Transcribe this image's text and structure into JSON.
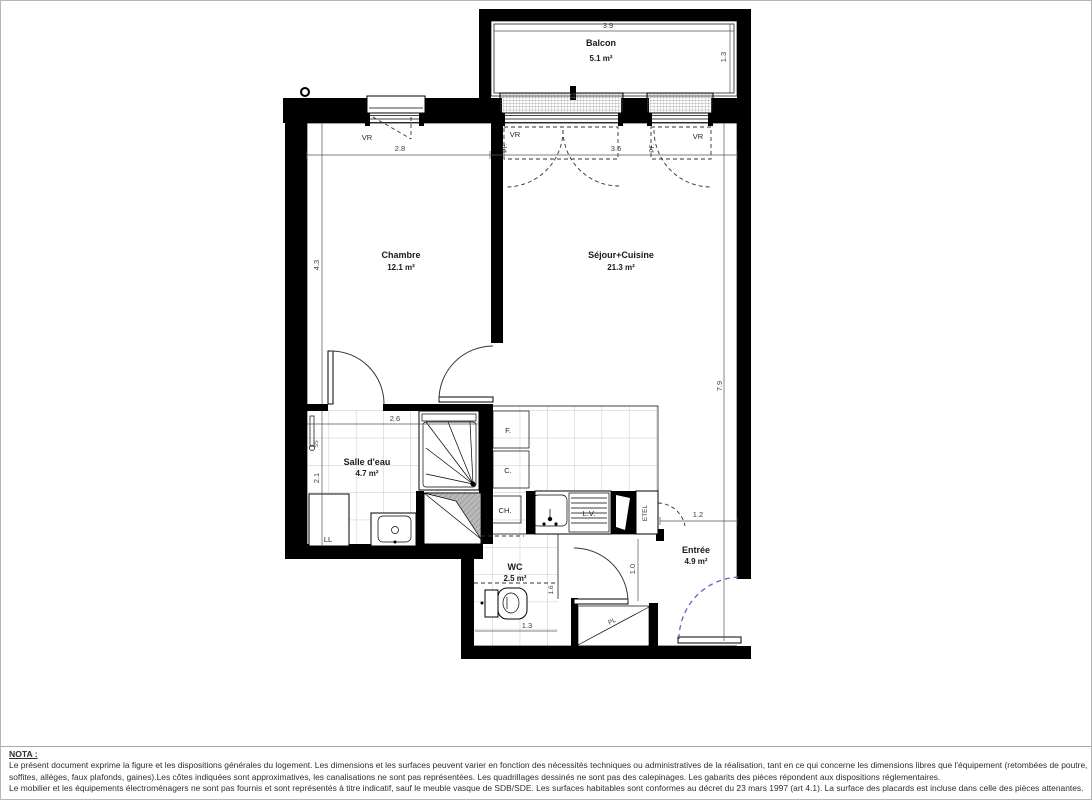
{
  "plan": {
    "rooms": {
      "balcon": {
        "name": "Balcon",
        "area": "5.1 m²"
      },
      "chambre": {
        "name": "Chambre",
        "area": "12.1 m²"
      },
      "sejour": {
        "name": "Séjour+Cuisine",
        "area": "21.3 m²"
      },
      "salle_eau": {
        "name": "Salle d'eau",
        "area": "4.7 m²"
      },
      "wc": {
        "name": "WC",
        "area": "2.5 m²"
      },
      "entree": {
        "name": "Entrée",
        "area": "4.9 m²"
      }
    },
    "dims": {
      "balcon_w": "3.9",
      "balcon_d": "1.3",
      "chambre_w": "2.8",
      "chambre_d": "4.3",
      "sejour_w": "3.6",
      "sejour_d": "7.9",
      "salle_eau_w": "2.6",
      "salle_eau_d": "2.1",
      "wc_w": "1.3",
      "wc_h": "1.6",
      "hall_d": "1.0",
      "entree_w": "1.2"
    },
    "labels": {
      "vr": "VR",
      "pf": "PF.",
      "f": "F.",
      "c": "C.",
      "ch": "CH.",
      "lv": "L.V.",
      "etel": "ETEL",
      "ll": "LL",
      "pl": "PL",
      "ss": "SS"
    },
    "colors": {
      "wall": "#000000",
      "tile_grid": "#beb8ae",
      "entry_arc": "#5555cc"
    }
  },
  "nota": {
    "title": "NOTA :",
    "lines": [
      "Le présent document exprime la figure et les dispositions générales du logement. Les dimensions et les surfaces peuvent varier en fonction des nécessités techniques ou administratives de la réalisation, tant en ce qui concerne les dimensions libres que l'équipement (retombées de poutre,",
      "soffites, allèges, faux plafonds, gaines).Les côtes indiquées sont approximatives, les canalisations ne sont pas représentées. Les quadrillages dessinés ne sont pas des calepinages. Les gabarits des pièces répondent aux dispositions réglementaires.",
      "Le mobilier et les équipements électroménagers ne sont pas fournis et sont représentés à titre indicatif, sauf le meuble vasque de SDB/SDE. Les surfaces habitables sont conformes au décret du 23 mars 1997 (art 4.1). La surface des placards est incluse dans celle des pièces attenantes."
    ]
  }
}
